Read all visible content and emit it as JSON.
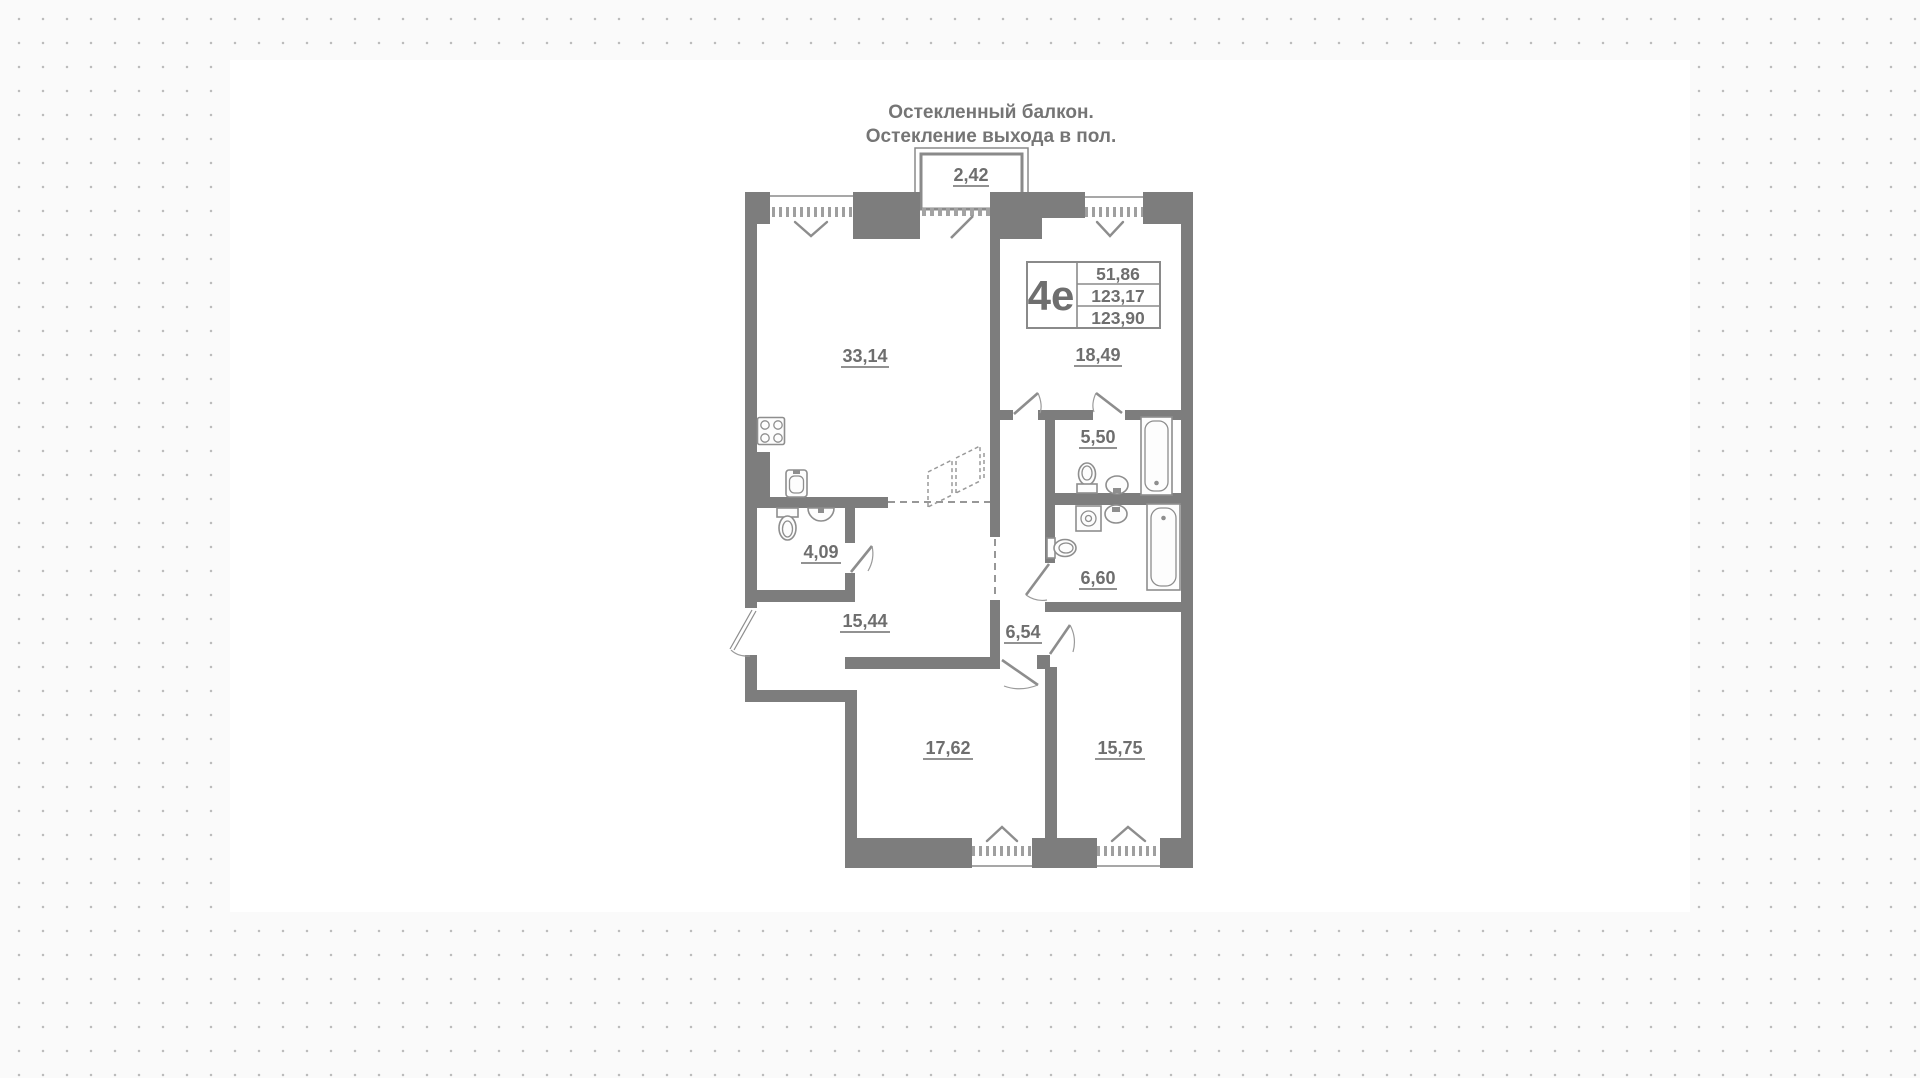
{
  "title": {
    "line1": "Остекленный балкон.",
    "line2": "Остекление выхода в пол."
  },
  "plan": {
    "balcony_area": "2,42",
    "info": {
      "type": "4е",
      "rows": [
        "51,86",
        "123,17",
        "123,90"
      ]
    },
    "rooms": {
      "living": "33,14",
      "bedroom": "18,49",
      "bath_top": "5,50",
      "bath_bottom": "6,60",
      "wc": "4,09",
      "hall": "15,44",
      "corridor": "6,54",
      "room_bottom_left": "17,62",
      "room_bottom_right": "15,75"
    }
  },
  "colors": {
    "wall": "#7d7d7d",
    "label": "#6e6e6e",
    "background": "#fafafa",
    "dot": "#bcbcbc",
    "canvas": "#ffffff"
  }
}
